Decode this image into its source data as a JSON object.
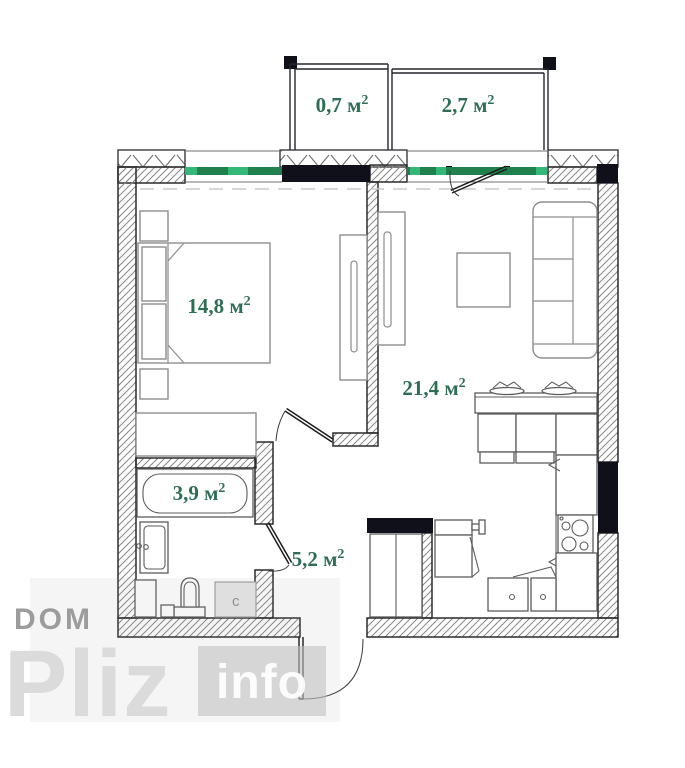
{
  "plan": {
    "sup": "2",
    "rooms": [
      {
        "id": "balcony-small",
        "label": "0,7 м"
      },
      {
        "id": "balcony-large",
        "label": "2,7 м"
      },
      {
        "id": "bedroom",
        "label": "14,8 м"
      },
      {
        "id": "living-kitchen",
        "label": "21,4 м"
      },
      {
        "id": "bathroom",
        "label": "3,9 м"
      },
      {
        "id": "hallway",
        "label": "5,2 м"
      }
    ],
    "appliance_label": "c"
  },
  "watermark": {
    "line1": "DOM",
    "line2": "Pliz",
    "badge": "info"
  },
  "colors": {
    "label_green": "#2e6e55",
    "window_green_dark": "#20814f",
    "window_green_bright": "#33b878",
    "wall_black": "#10101a",
    "watermark_gray": "#9c9c9c",
    "watermark_light": "#d9d9d9",
    "badge_gray": "#c2c2c2",
    "badge_text": "#ffffff"
  }
}
